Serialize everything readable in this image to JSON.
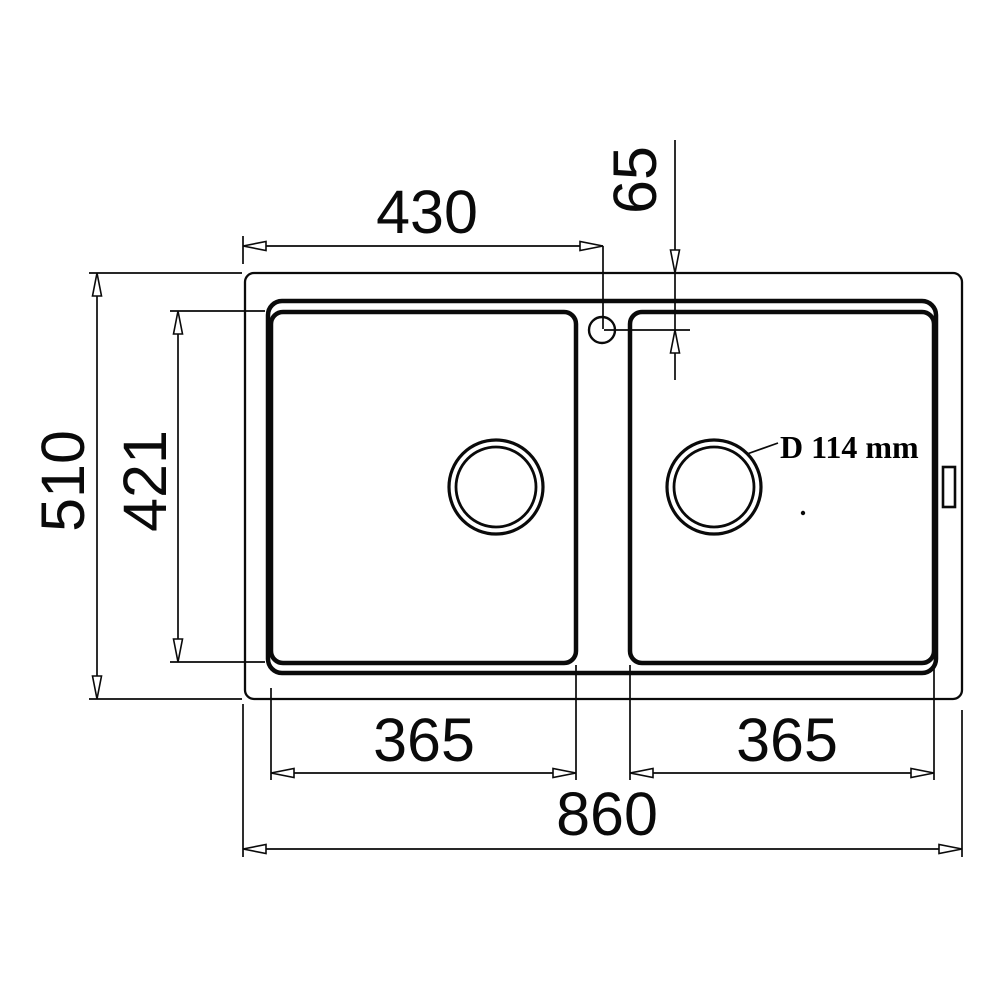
{
  "drawing": {
    "colors": {
      "line": "#0a0a0a",
      "background": "#ffffff"
    },
    "dims": {
      "top_width": "430",
      "faucet_offset": "65",
      "overall_depth": "510",
      "bowl_depth": "421",
      "left_bowl_width": "365",
      "right_bowl_width": "365",
      "overall_width": "860",
      "drain_diameter": "D 114 mm"
    }
  }
}
